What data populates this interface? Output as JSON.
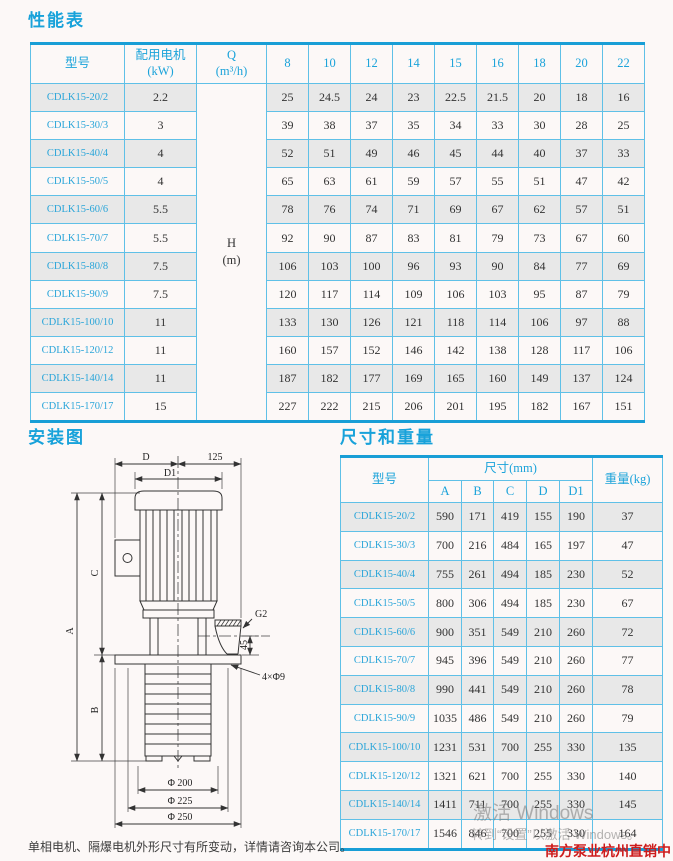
{
  "performance_table": {
    "title": "性能表",
    "col_model": "型号",
    "col_motor_line1": "配用电机",
    "col_motor_line2": "(kW)",
    "col_q_line1": "Q",
    "col_q_line2": "(m³/h)",
    "flow_headers": [
      "8",
      "10",
      "12",
      "14",
      "15",
      "16",
      "18",
      "20",
      "22"
    ],
    "h_line1": "H",
    "h_line2": "(m)",
    "rows": [
      {
        "model": "CDLK15-20/2",
        "kw": "2.2",
        "heads": [
          25,
          24.5,
          24,
          23,
          22.5,
          21.5,
          20,
          18,
          16
        ]
      },
      {
        "model": "CDLK15-30/3",
        "kw": "3",
        "heads": [
          39,
          38,
          37,
          35,
          34,
          33,
          30,
          28,
          25
        ]
      },
      {
        "model": "CDLK15-40/4",
        "kw": "4",
        "heads": [
          52,
          51,
          49,
          46,
          45,
          44,
          40,
          37,
          33
        ]
      },
      {
        "model": "CDLK15-50/5",
        "kw": "4",
        "heads": [
          65,
          63,
          61,
          59,
          57,
          55,
          51,
          47,
          42
        ]
      },
      {
        "model": "CDLK15-60/6",
        "kw": "5.5",
        "heads": [
          78,
          76,
          74,
          71,
          69,
          67,
          62,
          57,
          51
        ]
      },
      {
        "model": "CDLK15-70/7",
        "kw": "5.5",
        "heads": [
          92,
          90,
          87,
          83,
          81,
          79,
          73,
          67,
          60
        ]
      },
      {
        "model": "CDLK15-80/8",
        "kw": "7.5",
        "heads": [
          106,
          103,
          100,
          96,
          93,
          90,
          84,
          77,
          69
        ]
      },
      {
        "model": "CDLK15-90/9",
        "kw": "7.5",
        "heads": [
          120,
          117,
          114,
          109,
          106,
          103,
          95,
          87,
          79
        ]
      },
      {
        "model": "CDLK15-100/10",
        "kw": "11",
        "heads": [
          133,
          130,
          126,
          121,
          118,
          114,
          106,
          97,
          88
        ]
      },
      {
        "model": "CDLK15-120/12",
        "kw": "11",
        "heads": [
          160,
          157,
          152,
          146,
          142,
          138,
          128,
          117,
          106
        ]
      },
      {
        "model": "CDLK15-140/14",
        "kw": "11",
        "heads": [
          187,
          182,
          177,
          169,
          165,
          160,
          149,
          137,
          124
        ]
      },
      {
        "model": "CDLK15-170/17",
        "kw": "15",
        "heads": [
          227,
          222,
          215,
          206,
          201,
          195,
          182,
          167,
          151
        ]
      }
    ]
  },
  "installation": {
    "title": "安装图",
    "note": "单相电机、隔爆电机外形尺寸有所变动，详情请咨询本公司。",
    "labels": {
      "d": "D",
      "d1": "D1",
      "offset125": "125",
      "a": "A",
      "b": "B",
      "c": "C",
      "g2": "G2",
      "h45": "45",
      "holes": "4×Φ9",
      "phi200": "Φ 200",
      "phi225": "Φ 225",
      "phi250": "Φ 250"
    }
  },
  "dimensions_table": {
    "title": "尺寸和重量",
    "col_model": "型号",
    "group_header": "尺寸(mm)",
    "sub_headers": [
      "A",
      "B",
      "C",
      "D",
      "D1"
    ],
    "col_weight": "重量(kg)",
    "rows": [
      {
        "model": "CDLK15-20/2",
        "dims": [
          590,
          171,
          419,
          155,
          190
        ],
        "weight": 37
      },
      {
        "model": "CDLK15-30/3",
        "dims": [
          700,
          216,
          484,
          165,
          197
        ],
        "weight": 47
      },
      {
        "model": "CDLK15-40/4",
        "dims": [
          755,
          261,
          494,
          185,
          230
        ],
        "weight": 52
      },
      {
        "model": "CDLK15-50/5",
        "dims": [
          800,
          306,
          494,
          185,
          230
        ],
        "weight": 67
      },
      {
        "model": "CDLK15-60/6",
        "dims": [
          900,
          351,
          549,
          210,
          260
        ],
        "weight": 72
      },
      {
        "model": "CDLK15-70/7",
        "dims": [
          945,
          396,
          549,
          210,
          260
        ],
        "weight": 77
      },
      {
        "model": "CDLK15-80/8",
        "dims": [
          990,
          441,
          549,
          210,
          260
        ],
        "weight": 78
      },
      {
        "model": "CDLK15-90/9",
        "dims": [
          1035,
          486,
          549,
          210,
          260
        ],
        "weight": 79
      },
      {
        "model": "CDLK15-100/10",
        "dims": [
          1231,
          531,
          700,
          255,
          330
        ],
        "weight": 135
      },
      {
        "model": "CDLK15-120/12",
        "dims": [
          1321,
          621,
          700,
          255,
          330
        ],
        "weight": 140
      },
      {
        "model": "CDLK15-140/14",
        "dims": [
          1411,
          711,
          700,
          255,
          330
        ],
        "weight": 145
      },
      {
        "model": "CDLK15-170/17",
        "dims": [
          1546,
          846,
          700,
          255,
          330
        ],
        "weight": 164
      }
    ]
  },
  "watermark": {
    "line1": "激活 Windows",
    "line2": "转到“设置”以激活 Windows。"
  },
  "vendor": {
    "name": "南方泵业杭州直销中心"
  },
  "colors": {
    "accent": "#1ba3da",
    "border": "#5fc0e7",
    "border_strong": "#189ed6",
    "row_alt": "#e8e8e8",
    "vendor_red": "#cd1c1c"
  }
}
